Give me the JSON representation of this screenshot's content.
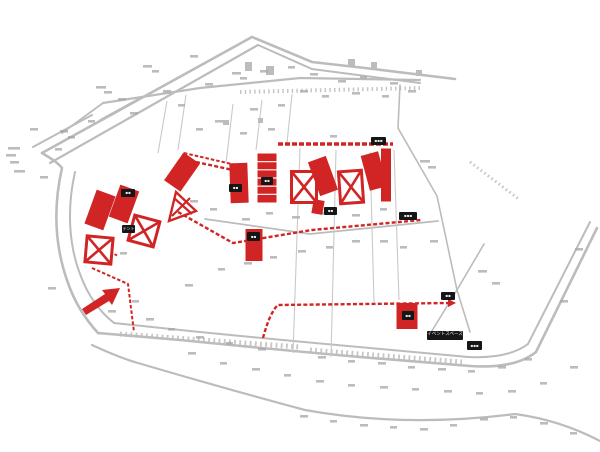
{
  "map": {
    "kind": "site-plan",
    "background": "#ffffff",
    "colors": {
      "accent_red": "#d12525",
      "road_gray": "#bcbcbc",
      "lot_gray": "#c9c9c9",
      "fragment_gray": "#a6a6a6",
      "label_bg": "#161616",
      "label_text": "#ededed"
    },
    "labels": [
      {
        "id": "label-1",
        "x": 121,
        "y": 189,
        "w": 14,
        "h": 8,
        "text": "▪▪",
        "fs": 4
      },
      {
        "id": "label-tent",
        "x": 122,
        "y": 225,
        "w": 13,
        "h": 8,
        "text": "テント",
        "fs": 4
      },
      {
        "id": "label-3",
        "x": 229,
        "y": 184,
        "w": 13,
        "h": 8,
        "text": "▪▪",
        "fs": 4
      },
      {
        "id": "label-4",
        "x": 261,
        "y": 177,
        "w": 12,
        "h": 8,
        "text": "▪▪",
        "fs": 4
      },
      {
        "id": "label-5",
        "x": 324,
        "y": 207,
        "w": 13,
        "h": 8,
        "text": "▪▪",
        "fs": 4
      },
      {
        "id": "label-6",
        "x": 247,
        "y": 232,
        "w": 13,
        "h": 9,
        "text": "▪▪",
        "fs": 4
      },
      {
        "id": "label-7",
        "x": 399,
        "y": 212,
        "w": 18,
        "h": 8,
        "text": "▪▪▪",
        "fs": 4
      },
      {
        "id": "label-8",
        "x": 441,
        "y": 292,
        "w": 14,
        "h": 8,
        "text": "▪▪",
        "fs": 4
      },
      {
        "id": "label-9",
        "x": 402,
        "y": 311,
        "w": 12,
        "h": 9,
        "text": "▪▪",
        "fs": 4
      },
      {
        "id": "label-event-space",
        "x": 427,
        "y": 331,
        "w": 36,
        "h": 9,
        "text": "イベントスペース",
        "fs": 4.5
      },
      {
        "id": "label-11",
        "x": 467,
        "y": 341,
        "w": 15,
        "h": 9,
        "text": "▪▪▪",
        "fs": 4
      },
      {
        "id": "label-12",
        "x": 371,
        "y": 137,
        "w": 15,
        "h": 8,
        "text": "▪▪▪",
        "fs": 4
      }
    ],
    "roads": [
      {
        "d": "M42,153 L252,37",
        "w": 2.6
      },
      {
        "d": "M50,163 L258,45",
        "w": 2.2
      },
      {
        "d": "M252,37 L312,62 L365,68 L455,79",
        "w": 2.6
      },
      {
        "d": "M258,45 L312,69 L420,83",
        "w": 2
      },
      {
        "d": "M33,147 L92,115",
        "w": 2
      },
      {
        "d": "M100,120 L140,98",
        "w": 1.8
      },
      {
        "d": "M62,133 L103,103",
        "w": 1.8
      },
      {
        "d": "M103,103 L200,88 L300,78 L420,80",
        "w": 2.2
      },
      {
        "d": "M42,153 C52,159 58,163 62,168 C52,212 56,250 68,283 C76,306 88,322 98,333",
        "w": 2.6
      },
      {
        "d": "M75,172 C66,212 70,248 80,274 C88,296 100,312 114,323",
        "w": 2
      },
      {
        "d": "M98,333 L180,340 Q280,350 360,357 L470,366 Q515,369 536,352 L597,228",
        "w": 2.6
      },
      {
        "d": "M114,323 L190,331 Q290,341 370,348 L468,357 Q508,359 528,344 L590,222",
        "w": 2
      },
      {
        "d": "M92,345 Q120,358 138,363 Q230,390 305,410 Q405,428 515,414 Q560,420 600,441",
        "w": 2.2
      },
      {
        "d": "M205,219 L310,234 L438,221",
        "w": 1.8
      },
      {
        "d": "M400,85 L398,128 L437,196 L457,290 L470,332",
        "w": 1.6
      },
      {
        "d": "M484,244 L457,290 L430,334",
        "w": 1.6
      }
    ],
    "tick_bands": [
      {
        "d": "M240,92 L420,88",
        "w": 4,
        "dash": "1.5,3.2"
      },
      {
        "d": "M120,334 L300,347",
        "w": 5,
        "dash": "1.8,3.4"
      },
      {
        "d": "M310,350 L462,362",
        "w": 5,
        "dash": "1.8,3.4"
      },
      {
        "d": "M470,162 L520,200",
        "w": 3,
        "dash": "1.5,3"
      }
    ],
    "lot_lines": [
      {
        "d": "M233,104 L226,163"
      },
      {
        "d": "M262,100 L256,150"
      },
      {
        "d": "M292,94 L287,143"
      },
      {
        "d": "M300,148 L293,353"
      },
      {
        "d": "M336,150 L331,357"
      },
      {
        "d": "M370,152 L374,302"
      },
      {
        "d": "M394,150 L399,300"
      },
      {
        "d": "M167,101 L158,153"
      },
      {
        "d": "M186,95 L178,150"
      }
    ],
    "gray_buildings": [
      {
        "x": 245,
        "y": 62,
        "w": 7,
        "h": 9
      },
      {
        "x": 266,
        "y": 66,
        "w": 8,
        "h": 9
      },
      {
        "x": 348,
        "y": 59,
        "w": 7,
        "h": 8
      },
      {
        "x": 371,
        "y": 62,
        "w": 6,
        "h": 7
      },
      {
        "x": 416,
        "y": 70,
        "w": 6,
        "h": 6
      },
      {
        "x": 223,
        "y": 120,
        "w": 6,
        "h": 5
      },
      {
        "x": 258,
        "y": 118,
        "w": 5,
        "h": 5
      }
    ],
    "red_routes": [
      {
        "d": "M178,212 L233,243 L312,230 L421,220",
        "w": 2.4,
        "dash": "4,2.2"
      },
      {
        "d": "M278,144 L393,144",
        "w": 3.4,
        "dash": "5,2"
      },
      {
        "d": "M196,162 L233,170",
        "w": 2.4,
        "dash": "4,2.2"
      },
      {
        "d": "M263,338 Q270,312 278,305 L448,303",
        "w": 2.4,
        "dash": "4,2.2"
      },
      {
        "d": "M92,268 L128,284 L134,332",
        "w": 2,
        "dash": "3.5,2"
      },
      {
        "d": "M184,153 L236,165",
        "w": 2,
        "dash": "3.5,2"
      },
      {
        "d": "M88,240 L118,256",
        "w": 1.8,
        "dash": "3,2"
      }
    ],
    "red_buildings": [
      {
        "type": "rect",
        "x": 100,
        "y": 210,
        "w": 20,
        "h": 36,
        "rot": 20
      },
      {
        "type": "rect",
        "x": 124,
        "y": 204,
        "w": 20,
        "h": 34,
        "rot": 20
      },
      {
        "type": "rect",
        "x": 182,
        "y": 172,
        "w": 20,
        "h": 34,
        "rot": 35
      },
      {
        "type": "tri",
        "pts": "169,221 196,211 176,192",
        "x1": 172,
        "y1": 216,
        "x2": 190,
        "y2": 198,
        "x3": 174,
        "y3": 198,
        "x4": 192,
        "y4": 214
      },
      {
        "type": "xbox",
        "x": 144,
        "y": 231,
        "w": 26,
        "h": 26,
        "rot": 15
      },
      {
        "type": "xbox",
        "x": 99,
        "y": 250,
        "w": 26,
        "h": 26,
        "rot": 5
      },
      {
        "type": "rect",
        "x": 239,
        "y": 183,
        "w": 18,
        "h": 40,
        "rot": -2
      },
      {
        "type": "striped",
        "x": 267,
        "y": 178,
        "w": 19,
        "h": 49,
        "rot": 0
      },
      {
        "type": "xbox",
        "x": 304,
        "y": 187,
        "w": 25,
        "h": 31,
        "rot": 0
      },
      {
        "type": "rect",
        "x": 323,
        "y": 176,
        "w": 19,
        "h": 36,
        "rot": -20
      },
      {
        "type": "xbox",
        "x": 351,
        "y": 187,
        "w": 23,
        "h": 32,
        "rot": -4
      },
      {
        "type": "rect",
        "x": 374,
        "y": 171,
        "w": 18,
        "h": 36,
        "rot": -15
      },
      {
        "type": "rect",
        "x": 386,
        "y": 175,
        "w": 10,
        "h": 53,
        "rot": 0
      },
      {
        "type": "rect",
        "x": 318,
        "y": 207,
        "w": 11,
        "h": 14,
        "rot": 10
      },
      {
        "type": "rect",
        "x": 254,
        "y": 245,
        "w": 17,
        "h": 32,
        "rot": 0
      },
      {
        "type": "rect",
        "x": 407,
        "y": 316,
        "w": 21,
        "h": 26,
        "rot": 0
      }
    ],
    "arrow_points": "82,309 86,315 109,301 112,305 120,288 102,290 105,294",
    "route_arrowhead": "448,299 456,303 448,307",
    "fragments": [
      [
        96,
        86,
        10
      ],
      [
        104,
        91,
        8
      ],
      [
        143,
        65,
        9
      ],
      [
        152,
        70,
        7
      ],
      [
        190,
        55,
        8
      ],
      [
        232,
        72,
        9
      ],
      [
        240,
        77,
        7
      ],
      [
        118,
        98,
        8
      ],
      [
        163,
        90,
        8
      ],
      [
        205,
        83,
        8
      ],
      [
        60,
        130,
        8
      ],
      [
        68,
        136,
        7
      ],
      [
        30,
        128,
        8
      ],
      [
        8,
        147,
        12
      ],
      [
        6,
        154,
        10
      ],
      [
        10,
        161,
        9
      ],
      [
        14,
        170,
        11
      ],
      [
        40,
        176,
        8
      ],
      [
        55,
        148,
        7
      ],
      [
        88,
        120,
        7
      ],
      [
        130,
        112,
        8
      ],
      [
        178,
        104,
        7
      ],
      [
        260,
        70,
        8
      ],
      [
        288,
        66,
        7
      ],
      [
        310,
        73,
        8
      ],
      [
        338,
        80,
        8
      ],
      [
        360,
        76,
        7
      ],
      [
        390,
        82,
        8
      ],
      [
        300,
        90,
        8
      ],
      [
        322,
        95,
        7
      ],
      [
        352,
        92,
        8
      ],
      [
        382,
        95,
        7
      ],
      [
        408,
        90,
        8
      ],
      [
        250,
        108,
        8
      ],
      [
        278,
        104,
        7
      ],
      [
        215,
        120,
        8
      ],
      [
        196,
        128,
        7
      ],
      [
        240,
        132,
        7
      ],
      [
        268,
        128,
        7
      ],
      [
        330,
        135,
        7
      ],
      [
        420,
        160,
        10
      ],
      [
        428,
        166,
        8
      ],
      [
        190,
        200,
        8
      ],
      [
        210,
        208,
        7
      ],
      [
        242,
        218,
        8
      ],
      [
        266,
        212,
        7
      ],
      [
        292,
        216,
        8
      ],
      [
        320,
        212,
        7
      ],
      [
        352,
        214,
        8
      ],
      [
        380,
        208,
        7
      ],
      [
        352,
        240,
        8
      ],
      [
        326,
        246,
        7
      ],
      [
        298,
        250,
        8
      ],
      [
        270,
        256,
        7
      ],
      [
        244,
        262,
        8
      ],
      [
        218,
        268,
        7
      ],
      [
        380,
        240,
        8
      ],
      [
        400,
        246,
        7
      ],
      [
        430,
        240,
        8
      ],
      [
        478,
        270,
        9
      ],
      [
        492,
        282,
        8
      ],
      [
        575,
        248,
        8
      ],
      [
        560,
        300,
        8
      ],
      [
        48,
        287,
        8
      ],
      [
        120,
        252,
        7
      ],
      [
        185,
        284,
        8
      ],
      [
        146,
        318,
        8
      ],
      [
        168,
        328,
        7
      ],
      [
        196,
        336,
        8
      ],
      [
        226,
        342,
        7
      ],
      [
        258,
        348,
        8
      ],
      [
        318,
        356,
        8
      ],
      [
        348,
        360,
        7
      ],
      [
        378,
        362,
        8
      ],
      [
        408,
        366,
        7
      ],
      [
        438,
        368,
        8
      ],
      [
        468,
        370,
        7
      ],
      [
        498,
        366,
        8
      ],
      [
        525,
        358,
        7
      ],
      [
        188,
        352,
        8
      ],
      [
        220,
        362,
        7
      ],
      [
        252,
        368,
        8
      ],
      [
        284,
        374,
        7
      ],
      [
        316,
        380,
        8
      ],
      [
        348,
        384,
        7
      ],
      [
        380,
        386,
        8
      ],
      [
        412,
        388,
        7
      ],
      [
        444,
        390,
        8
      ],
      [
        476,
        392,
        7
      ],
      [
        508,
        390,
        8
      ],
      [
        540,
        382,
        7
      ],
      [
        570,
        366,
        8
      ],
      [
        300,
        415,
        8
      ],
      [
        330,
        420,
        7
      ],
      [
        360,
        424,
        8
      ],
      [
        390,
        426,
        7
      ],
      [
        420,
        428,
        8
      ],
      [
        450,
        424,
        7
      ],
      [
        480,
        418,
        8
      ],
      [
        510,
        416,
        7
      ],
      [
        540,
        422,
        8
      ],
      [
        570,
        432,
        7
      ],
      [
        132,
        300,
        7
      ],
      [
        108,
        310,
        8
      ]
    ]
  }
}
